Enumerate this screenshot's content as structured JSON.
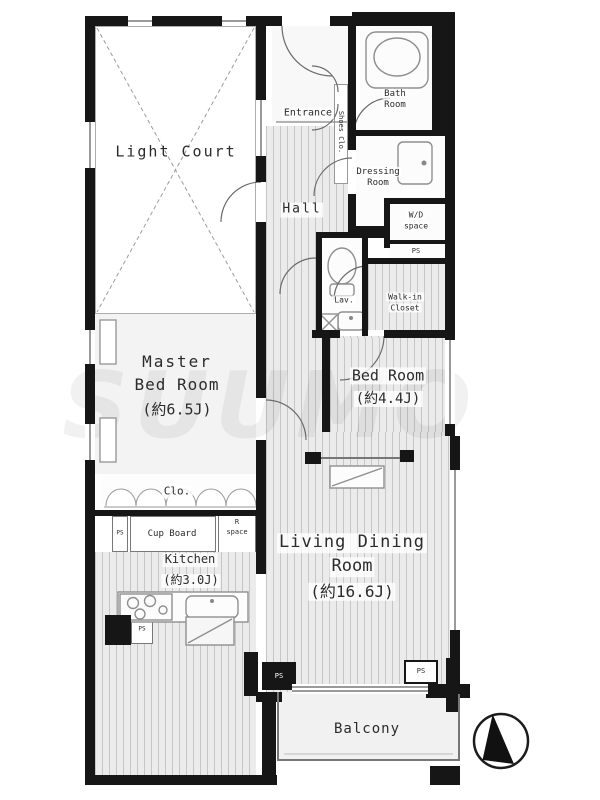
{
  "rooms": {
    "light_court": {
      "name": "Light Court"
    },
    "entrance": {
      "name": "Entrance"
    },
    "shoes_closet": {
      "name": "Shoes Clo."
    },
    "hall": {
      "name": "Hall"
    },
    "bath_room": {
      "line1": "Bath",
      "line2": "Room"
    },
    "dressing_room": {
      "line1": "Dressing",
      "line2": "Room"
    },
    "wd_space": {
      "line1": "W/D",
      "line2": "space"
    },
    "walk_in_closet": {
      "line1": "Walk-in",
      "line2": "Closet"
    },
    "lavatory": {
      "name": "Lav."
    },
    "master_bedroom": {
      "line1": "Master",
      "line2": "Bed Room",
      "size": "(約6.5J)"
    },
    "bedroom": {
      "line1": "Bed Room",
      "size": "(約4.4J)"
    },
    "closet": {
      "name": "Clo."
    },
    "cup_board": {
      "name": "Cup Board"
    },
    "r_space": {
      "line1": "R",
      "line2": "space"
    },
    "kitchen": {
      "line1": "Kitchen",
      "size": "(約3.0J)"
    },
    "living_dining": {
      "line1": "Living Dining",
      "line2": "Room",
      "size": "(約16.6J)"
    },
    "balcony": {
      "name": "Balcony"
    }
  },
  "service": {
    "ps": "PS"
  },
  "watermark": "SUUMO",
  "compass": {
    "icon": "north-arrow"
  },
  "colors": {
    "wall": "#161616",
    "stripe": "#c6c6c6",
    "floor": "#ebebeb",
    "text": "#2b2b2b"
  }
}
